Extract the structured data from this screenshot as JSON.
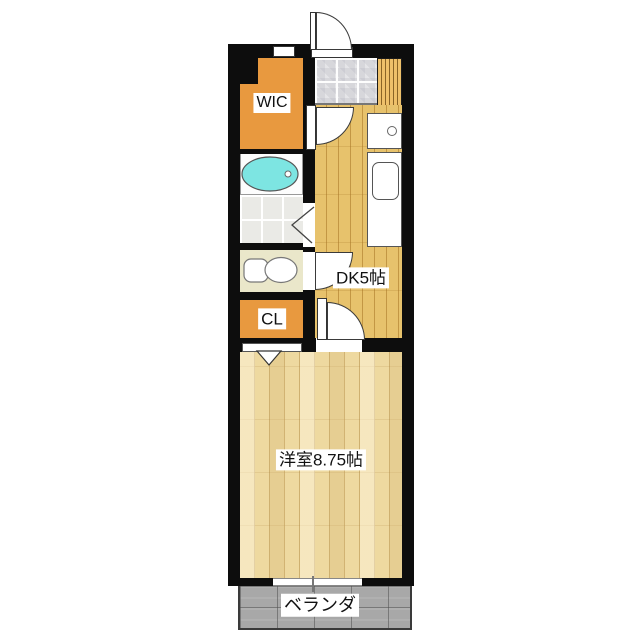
{
  "floorplan": {
    "labels": {
      "wic": "WIC",
      "closet": "CL",
      "dining_kitchen": "DK5帖",
      "western_room": "洋室8.75帖",
      "balcony": "ベランダ"
    },
    "icons": {
      "entrance_door": "quarter-arc-swing-door",
      "hall_door": "quarter-arc-swing-door",
      "toilet_door": "quarter-arc-swing-door",
      "room_door": "quarter-arc-swing-door",
      "bath_folding_door": "chevron-folding-door",
      "closet_folding_door": "triangle-folding-door",
      "bathtub": "oval-tub-with-drain",
      "toilet": "tank-and-bowl",
      "kitchen_sink": "rounded-rect-sink-counter",
      "stove_or_washer": "box-with-circle",
      "shoe_cabinet": "vertical-striped-cabinet",
      "windows": "white-bar-in-wall"
    },
    "colors": {
      "wall": "#0d0d0d",
      "storage_orange": "#e8993f",
      "bathtub_cyan": "#7de5e2",
      "dk_floor": "#e7c26c",
      "room_floor": "#eed9a0",
      "toilet_floor": "#eae7ca",
      "entrance_tile": "#d7d7db",
      "bath_tile": "#eaeae6",
      "balcony_gray": "#a8a8a8",
      "background": "#ffffff"
    }
  }
}
